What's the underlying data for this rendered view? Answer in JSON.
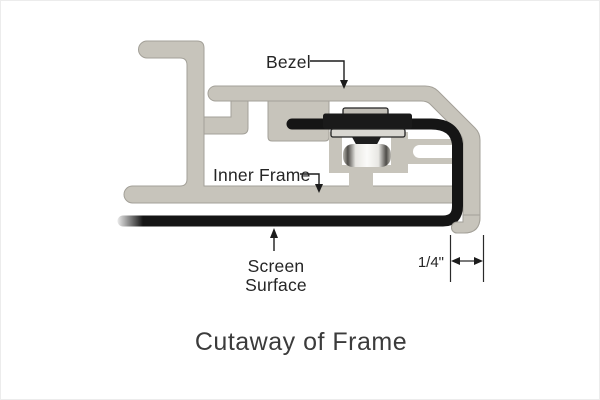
{
  "diagram": {
    "labels": {
      "bezel": "Bezel",
      "inner_frame": "Inner Frame",
      "screen_surface_line1": "Screen",
      "screen_surface_line2": "Surface",
      "dimension": "1/4\"",
      "title": "Cutaway of Frame"
    },
    "colors": {
      "aluminum": "#c7c4bb",
      "aluminum_edge": "#a3a098",
      "screen_black": "#151515",
      "mechanism_dark": "#1a1a1a",
      "washer_light": "#d9d7d1",
      "label_text": "#252525",
      "title_text": "#3b3b3b",
      "background": "#ffffff"
    }
  }
}
